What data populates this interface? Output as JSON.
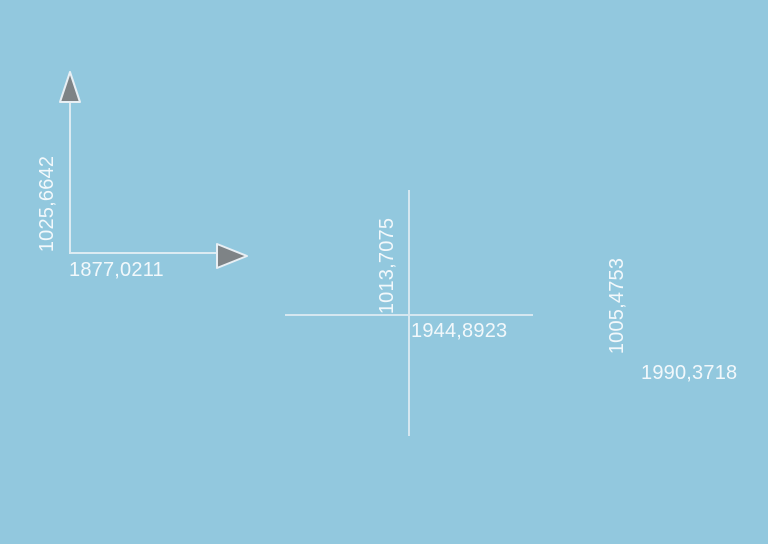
{
  "canvas": {
    "background_color": "#92c8de",
    "line_color": "#dcebf2",
    "crosshair_line_color": "#d5e7f0",
    "text_color": "#f2f8fb",
    "arrow_fill": "#7e8386",
    "arrow_stroke": "#e8eff4"
  },
  "markers": {
    "axis_marker": {
      "y_label": "1025,6642",
      "x_label": "1877,0211"
    },
    "crosshair_marker": {
      "y_label": "1013,7075",
      "x_label": "1944,8923"
    },
    "floating_marker": {
      "y_label": "1005,4753",
      "x_label": "1990,3718"
    }
  }
}
